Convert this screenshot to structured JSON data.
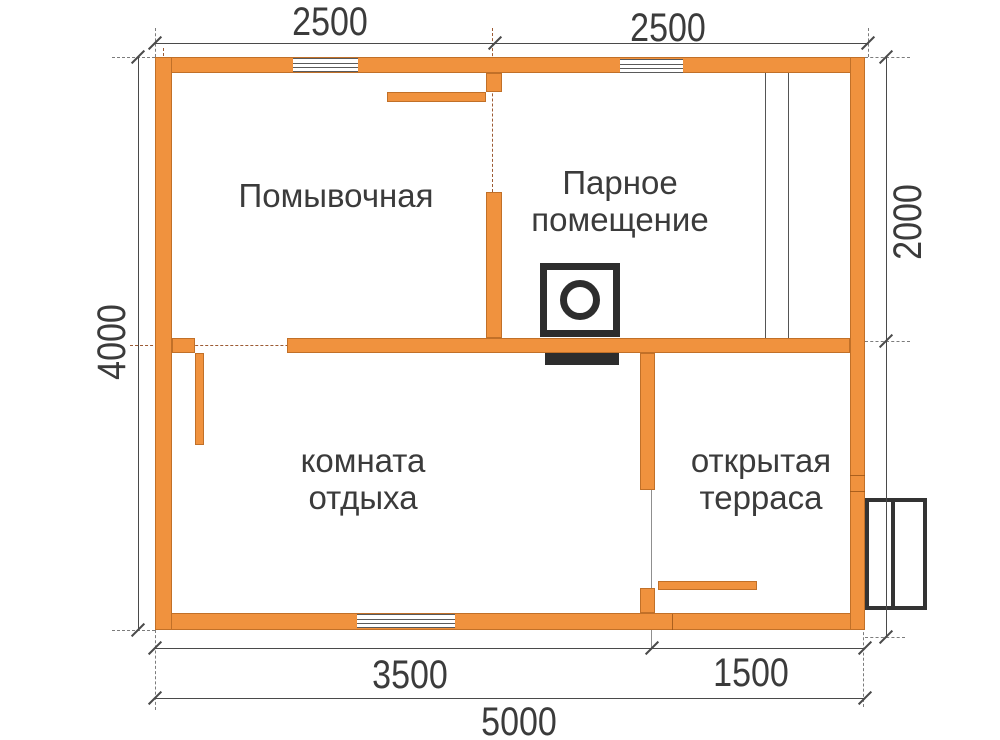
{
  "drawing": {
    "rooms": {
      "washroom": {
        "line1": "Помывочная"
      },
      "steam_room": {
        "line1": "Парное",
        "line2": "помещение"
      },
      "rest_room": {
        "line1": "комната",
        "line2": "отдыха"
      },
      "terrace": {
        "line1": "открытая",
        "line2": "терраса"
      }
    },
    "dimensions": {
      "top_left_width": "2500",
      "top_right_width": "2500",
      "left_height": "4000",
      "right_height": "2000",
      "bottom_rest_width": "3500",
      "bottom_terrace_width": "1500",
      "bottom_total_width": "5000"
    },
    "colors": {
      "wall": "#F0923E",
      "wall_edge": "#A95F1C",
      "axis_dash": "#8B3E10",
      "dim_line": "#4A4A4A",
      "text": "#3B3B3B",
      "symbol": "#2D2D2D",
      "background": "#FFFFFF"
    }
  }
}
